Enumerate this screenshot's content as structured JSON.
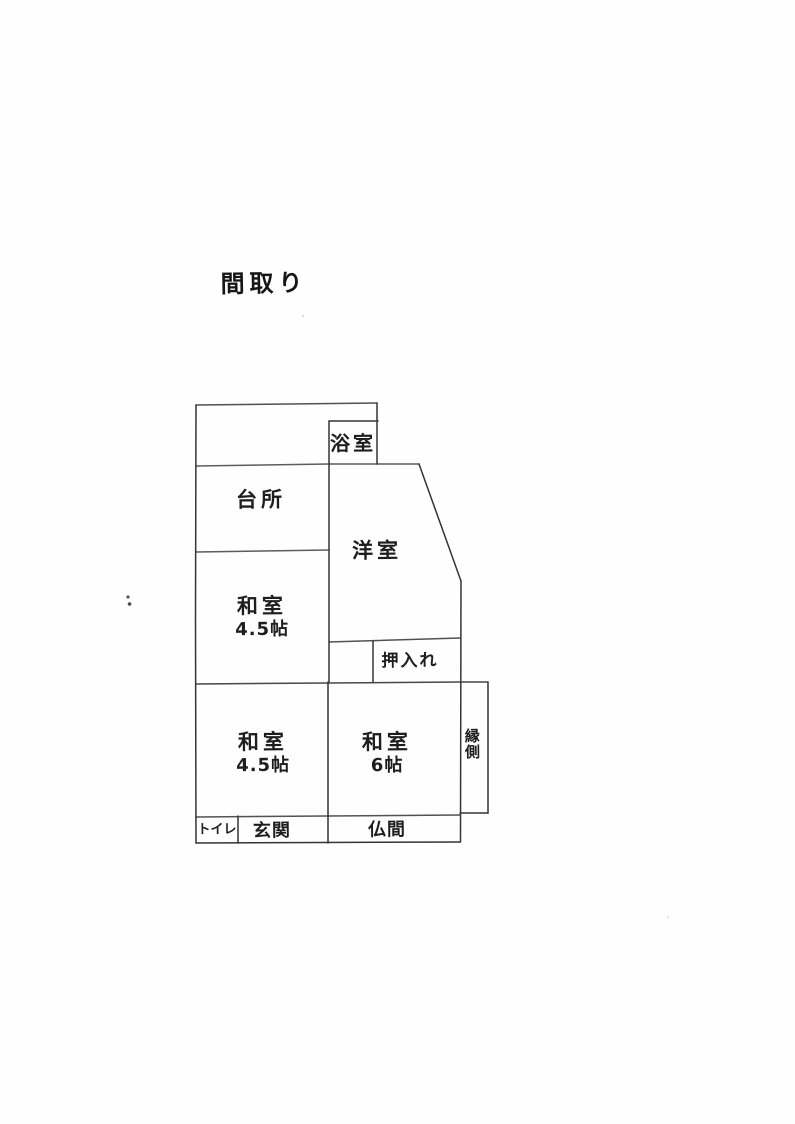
{
  "document": {
    "title": "間取り"
  },
  "rooms": {
    "bath": {
      "label": "浴室"
    },
    "kitchen": {
      "label": "台所"
    },
    "western_room": {
      "label": "洋室"
    },
    "japanese_room_upper": {
      "label": "和室",
      "size": "4.5帖"
    },
    "closet": {
      "label": "押入れ"
    },
    "japanese_room_lower_left": {
      "label": "和室",
      "size": "4.5帖"
    },
    "japanese_room_lower_right": {
      "label": "和室",
      "size": "6帖"
    },
    "veranda": {
      "label": "縁側"
    },
    "toilet": {
      "label": "トイレ"
    },
    "entrance": {
      "label": "玄関"
    },
    "altar_room": {
      "label": "仏間"
    }
  }
}
